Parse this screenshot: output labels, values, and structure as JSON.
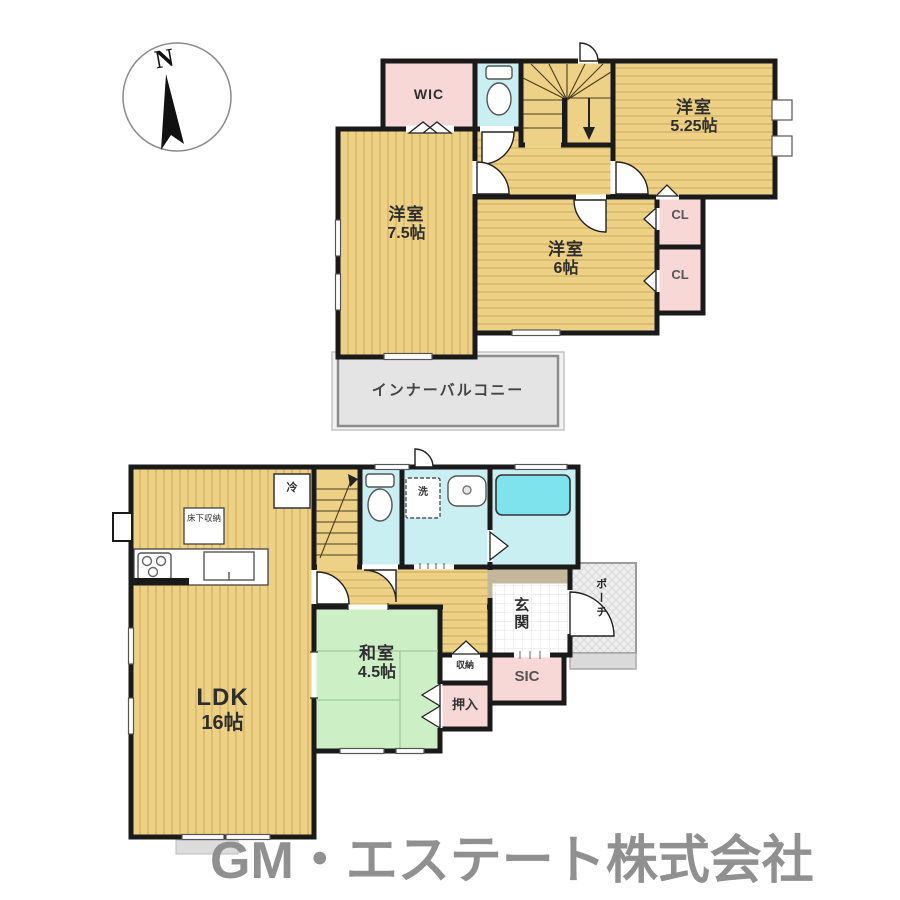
{
  "compass": {
    "north_label": "N"
  },
  "floor2": {
    "wic": {
      "label": "WIC"
    },
    "room_525": {
      "name": "洋室",
      "size": "5.25帖"
    },
    "room_75": {
      "name": "洋室",
      "size": "7.5帖"
    },
    "room_6": {
      "name": "洋室",
      "size": "6帖"
    },
    "closet_1": {
      "label": "CL"
    },
    "closet_2": {
      "label": "CL"
    },
    "inner_balcony": {
      "label": "インナーバルコニー"
    }
  },
  "floor1": {
    "ldk": {
      "name": "LDK",
      "size": "16帖"
    },
    "washitsu": {
      "name": "和室",
      "size": "4.5帖"
    },
    "genkan": {
      "label": "玄関"
    },
    "porch": {
      "label": "ポーチ"
    },
    "sic": {
      "label": "SIC"
    },
    "oshiire": {
      "label": "押入"
    },
    "shuno": {
      "label": "収納"
    },
    "laundry": {
      "label": "洗"
    },
    "fridge": {
      "label": "冷"
    },
    "floor_storage": {
      "label": "床下収納"
    }
  },
  "watermark": "GM・エステート株式会社",
  "colors": {
    "wall": "#1a1a1a",
    "room_tan": "#edd186",
    "tan_stripe": "#d9b767",
    "pink": "#f8d7d7",
    "cyan": "#c9eff3",
    "bathtub": "#7fe3ee",
    "green": "#cdefc6",
    "balcony_gray": "#e4e4e4",
    "entry_step": "#c3b79b",
    "watermark_gray": "#8b8b8b"
  }
}
